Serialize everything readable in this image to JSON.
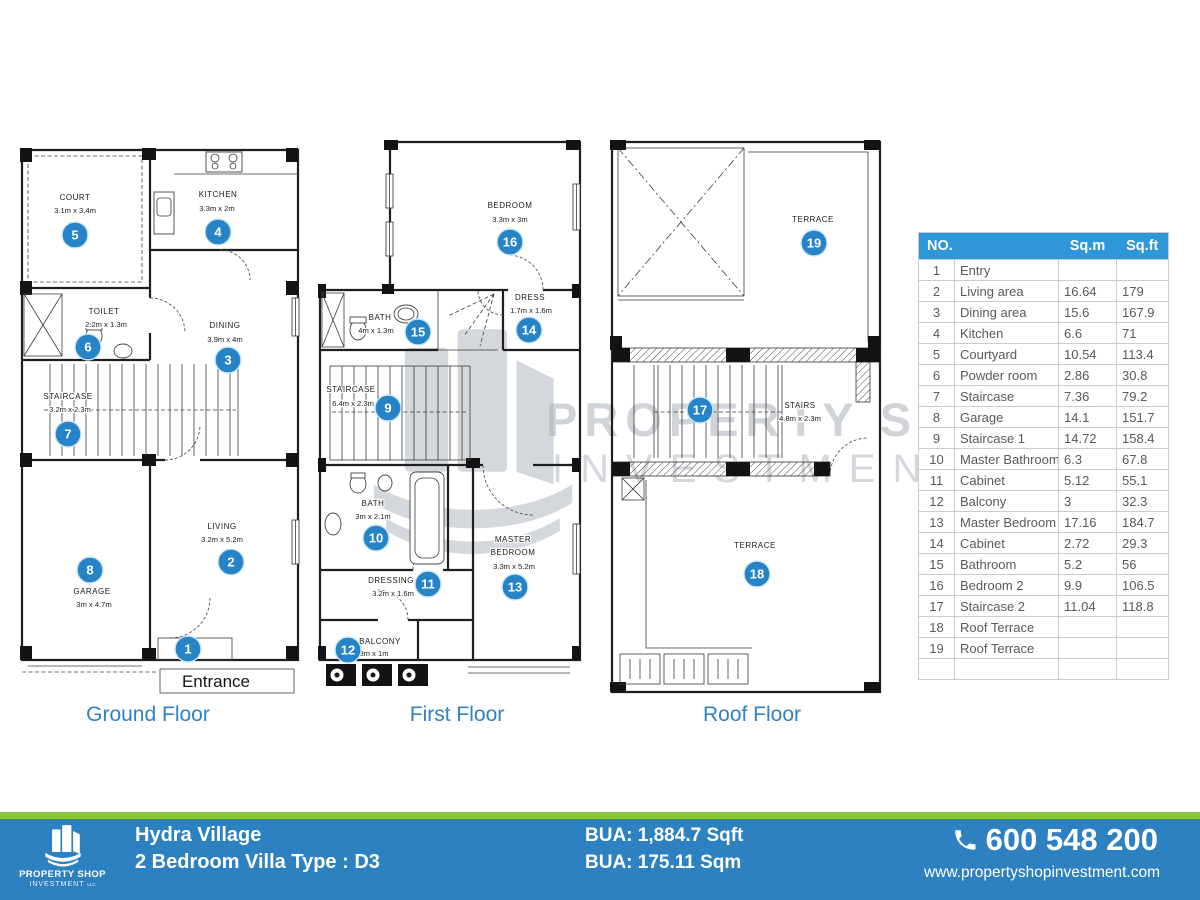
{
  "plans": {
    "ground": {
      "title": "Ground Floor",
      "entrance_box": "Entrance",
      "rooms": {
        "court": {
          "no": "5",
          "name": "COURT",
          "dims": "3.1m x 3.4m"
        },
        "kitchen": {
          "no": "4",
          "name": "KITCHEN",
          "dims": "3.3m x 2m"
        },
        "dining": {
          "no": "3",
          "name": "DINING",
          "dims": "3.9m x 4m"
        },
        "toilet": {
          "no": "6",
          "name": "TOILET",
          "dims": "2.2m x 1.3m"
        },
        "staircase": {
          "no": "7",
          "name": "STAIRCASE",
          "dims": "3.2m x 2.3m"
        },
        "garage": {
          "no": "8",
          "name": "GARAGE",
          "dims": "3m x 4.7m"
        },
        "living": {
          "no": "2",
          "name": "LIVING",
          "dims": "3.2m x 5.2m"
        },
        "entry": {
          "no": "1"
        }
      }
    },
    "first": {
      "title": "First Floor",
      "rooms": {
        "bedroom": {
          "no": "16",
          "name": "BEDROOM",
          "dims": "3.3m x 3m"
        },
        "dress": {
          "no": "14",
          "name": "DRESS",
          "dims": "1.7m x 1.6m"
        },
        "bath": {
          "no": "15",
          "name": "BATH",
          "dims": "4m x 1.3m"
        },
        "staircase": {
          "no": "9",
          "name": "STAIRCASE",
          "dims": "6.4m x 2.3m"
        },
        "master_bath": {
          "no": "10",
          "name": "BATH",
          "dims": "3m x 2.1m"
        },
        "dressing": {
          "no": "11",
          "name": "DRESSING",
          "dims": "3.2m x 1.6m"
        },
        "master": {
          "no": "13",
          "name1": "MASTER",
          "name2": "BEDROOM",
          "dims": "3.3m x 5.2m"
        },
        "balcony": {
          "no": "12",
          "name": "BALCONY",
          "dims": "3m x 1m"
        }
      }
    },
    "roof": {
      "title": "Roof Floor",
      "rooms": {
        "terrace_upper": {
          "no": "19",
          "name": "TERRACE"
        },
        "stairs": {
          "no": "17",
          "name": "STAIRS",
          "dims": "4.8m x 2.3m"
        },
        "terrace_lower": {
          "no": "18",
          "name": "TERRACE"
        }
      }
    }
  },
  "table": {
    "header": {
      "no": "NO.",
      "sqm": "Sq.m",
      "sqft": "Sq.ft"
    },
    "rows": [
      {
        "no": "1",
        "name": "Entry",
        "sqm": "",
        "sqft": ""
      },
      {
        "no": "2",
        "name": "Living area",
        "sqm": "16.64",
        "sqft": "179"
      },
      {
        "no": "3",
        "name": "Dining area",
        "sqm": "15.6",
        "sqft": "167.9"
      },
      {
        "no": "4",
        "name": "Kitchen",
        "sqm": "6.6",
        "sqft": "71"
      },
      {
        "no": "5",
        "name": "Courtyard",
        "sqm": "10.54",
        "sqft": "113.4"
      },
      {
        "no": "6",
        "name": "Powder room",
        "sqm": "2.86",
        "sqft": "30.8"
      },
      {
        "no": "7",
        "name": "Staircase",
        "sqm": "7.36",
        "sqft": "79.2"
      },
      {
        "no": "8",
        "name": "Garage",
        "sqm": "14.1",
        "sqft": "151.7"
      },
      {
        "no": "9",
        "name": "Staircase 1",
        "sqm": "14.72",
        "sqft": "158.4"
      },
      {
        "no": "10",
        "name": "Master Bathroom",
        "sqm": "6.3",
        "sqft": "67.8"
      },
      {
        "no": "11",
        "name": "Cabinet",
        "sqm": "5.12",
        "sqft": "55.1"
      },
      {
        "no": "12",
        "name": "Balcony",
        "sqm": "3",
        "sqft": "32.3"
      },
      {
        "no": "13",
        "name": "Master Bedroom",
        "sqm": "17.16",
        "sqft": "184.7"
      },
      {
        "no": "14",
        "name": "Cabinet",
        "sqm": "2.72",
        "sqft": "29.3"
      },
      {
        "no": "15",
        "name": "Bathroom",
        "sqm": "5.2",
        "sqft": "56"
      },
      {
        "no": "16",
        "name": "Bedroom 2",
        "sqm": "9.9",
        "sqft": "106.5"
      },
      {
        "no": "17",
        "name": "Staircase 2",
        "sqm": "11.04",
        "sqft": "118.8"
      },
      {
        "no": "18",
        "name": "Roof Terrace",
        "sqm": "",
        "sqft": ""
      },
      {
        "no": "19",
        "name": "Roof Terrace",
        "sqm": "",
        "sqft": ""
      },
      {
        "no": "",
        "name": "",
        "sqm": "",
        "sqft": ""
      }
    ]
  },
  "watermark": {
    "brand": "PROPERTY SHOP",
    "brand2": "INVESTMENT",
    "llc": "LLC"
  },
  "footer": {
    "logo": {
      "line1": "PROPERTY SHOP",
      "line2": "INVESTMENT",
      "llc": "LLC"
    },
    "project": "Hydra Village",
    "unit": "2 Bedroom Villa Type : D3",
    "bua_sqft": "BUA: 1,884.7 Sqft",
    "bua_sqm": "BUA: 175.11 Sqm",
    "phone": "600 548 200",
    "website": "www.propertyshopinvestment.com"
  },
  "colors": {
    "accent": "#2583C6",
    "table_header": "#2D97D8",
    "footer_blue": "#2E81C1",
    "footer_green": "#8CC63E",
    "watermark_gray": "#AAB1BA"
  }
}
